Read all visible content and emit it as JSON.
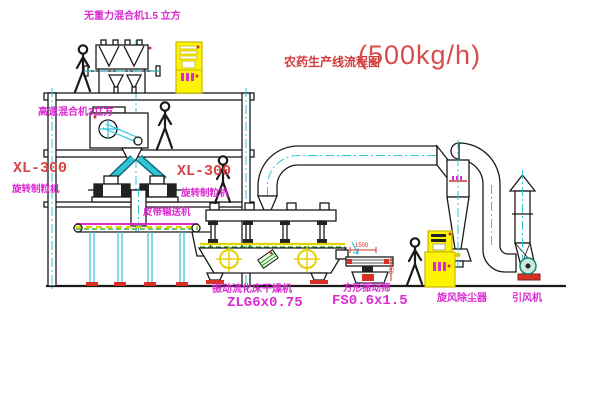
{
  "title": {
    "text_zh": "农药生产线流程图",
    "capacity": "(500kg/h)"
  },
  "equipment_labels": {
    "gravity_mixer": "无重力混合机1.5 立方",
    "high_speed_mixer": "高速混合机3立方",
    "granulator_left_model": "XL-300",
    "granulator_left_name": "旋转制粒机",
    "granulator_right_model": "XL-300",
    "granulator_right_name": "旋转制粒机",
    "belt_conveyor": "皮带输送机",
    "fluidbed_dryer": "振动流化床干燥机",
    "fluidbed_dryer_model": "ZLG6x0.75",
    "square_screen": "方形振动筛",
    "square_screen_model": "FS0.6x1.5",
    "cyclone": "旋风除尘器",
    "induced_fan": "引风机"
  },
  "dimensions": {
    "screen_length": "1500",
    "screen_height": "750"
  },
  "colors": {
    "label_magenta": "#d92bd0",
    "cad_red": "#d94545",
    "cad_cyan": "#2ec5d6",
    "cabinet_yellow": "#fcf403",
    "cad_green": "#21a121"
  }
}
